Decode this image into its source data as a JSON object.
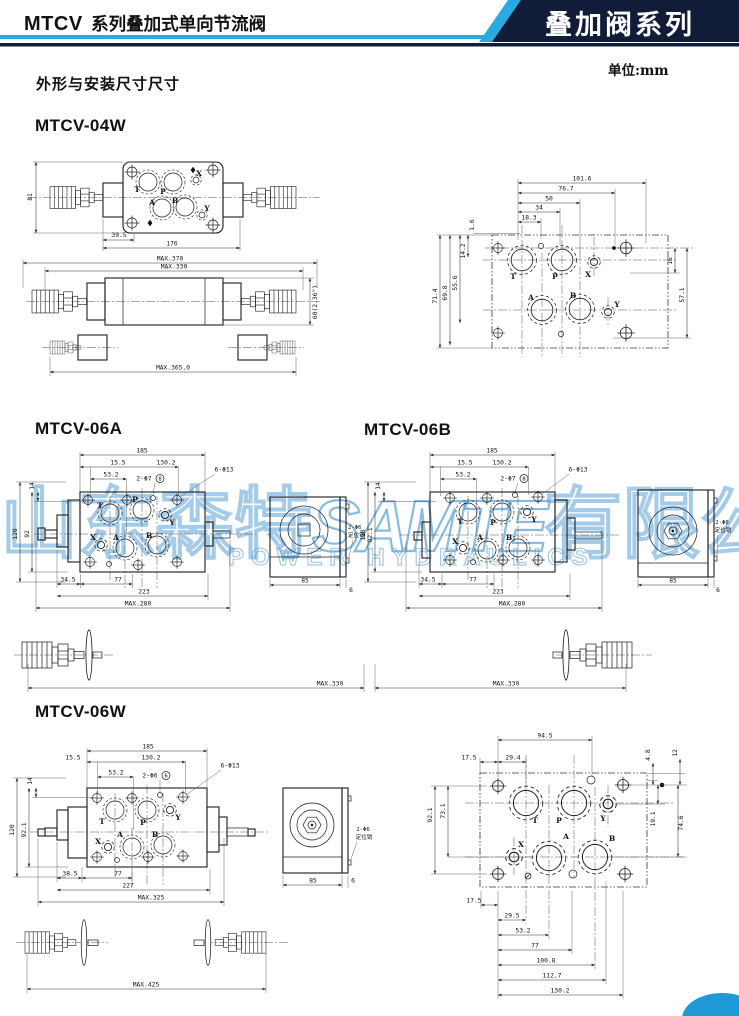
{
  "header": {
    "model_bold": "MTCV",
    "model_rest": "系列叠加式单向节流阀",
    "banner": "叠加阀系列",
    "unit": "单位:mm",
    "subtitle": "外形与安装尺寸尺寸"
  },
  "watermark": {
    "cn_left": "山东森特",
    "brand": "SAMTE",
    "cn_right": "有限公司",
    "en": "POWER HYDRAULICS"
  },
  "m04w": {
    "title": "MTCV-04W",
    "top": {
      "h": "81",
      "d1": "39.5",
      "d2": "176",
      "pT": "T",
      "pP": "P",
      "pA": "A",
      "pB": "B",
      "pX": "X",
      "pY": "Y"
    },
    "side": {
      "max1": "MAX.370",
      "max2": "MAX.330",
      "h": "60(2.36\")"
    },
    "bot": {
      "max": "MAX.365.0"
    },
    "face": {
      "top": [
        "101.6",
        "76.7",
        "50",
        "34",
        "18.3"
      ],
      "left": [
        "1.6",
        "14.2",
        "55.6",
        "69.8",
        "71.4"
      ],
      "right": [
        "16",
        "57.1"
      ],
      "pT": "T",
      "pP": "P",
      "pX": "X",
      "pA": "A",
      "pB": "B",
      "pY": "Y"
    }
  },
  "m06a": {
    "title": "MTCV-06A",
    "w": "185",
    "o": "15.5",
    "b": "130.2",
    "c": "53.2",
    "holes": "2-Φ7",
    "hn": "8",
    "bolts": "6-Φ13",
    "v1": "14",
    "v2": "92",
    "v3": "120",
    "g1": "34.5",
    "g2": "77",
    "g3": "223",
    "gm": "MAX.280",
    "km": "MAX.330",
    "pT": "T",
    "pP": "P",
    "pY": "Y",
    "pX": "X",
    "pA": "A",
    "pB": "B",
    "end": {
      "w": "85",
      "t": "6",
      "pin1": "2-Φ6",
      "pin2": "定位销"
    }
  },
  "m06b": {
    "title": "MTCV-06B",
    "w": "185",
    "o": "15.5",
    "b": "130.2",
    "c": "53.2",
    "holes": "2-Φ7",
    "hn": "8",
    "bolts": "6-Φ13",
    "v1": "14",
    "v2": "92.1",
    "v3": "120",
    "g1": "34.5",
    "g2": "77",
    "g3": "223",
    "gm": "MAX.280",
    "km": "MAX.330",
    "pT": "T",
    "pP": "P",
    "pY": "Y",
    "pX": "X",
    "pA": "A",
    "pB": "B",
    "end": {
      "w": "85",
      "t": "6",
      "pin1": "2-Φ6",
      "pin2": "定位销"
    }
  },
  "m06w": {
    "title": "MTCV-06W",
    "w": "185",
    "o": "15.5",
    "b": "130.2",
    "c": "53.2",
    "holes": "2-Φ6",
    "hn": "6",
    "bolts": "6-Φ13",
    "v1": "14",
    "v2": "92.1",
    "v3": "120",
    "g1": "38.5",
    "g2": "77",
    "g3": "227",
    "gm": "MAX.325",
    "km": "MAX.425",
    "pT": "T",
    "pP": "P",
    "pY": "Y",
    "pX": "X",
    "pA": "A",
    "pB": "B",
    "end": {
      "w": "85",
      "t": "6",
      "pin1": "2-Φ6",
      "pin2": "定位销"
    }
  },
  "m06wface": {
    "t1": "94.5",
    "t2": "29.4",
    "tl": "17.5",
    "tr1": "4.8",
    "tr2": "12",
    "l1": "92.1",
    "l2": "73.1",
    "r1": "19.1",
    "r2": "74.6",
    "b": [
      "17.5",
      "29.5",
      "53.2",
      "77",
      "100.8",
      "112.7",
      "130.2"
    ],
    "pT": "T",
    "pP": "P",
    "pY": "Y",
    "pX": "X",
    "pA": "A",
    "pB": "B"
  }
}
